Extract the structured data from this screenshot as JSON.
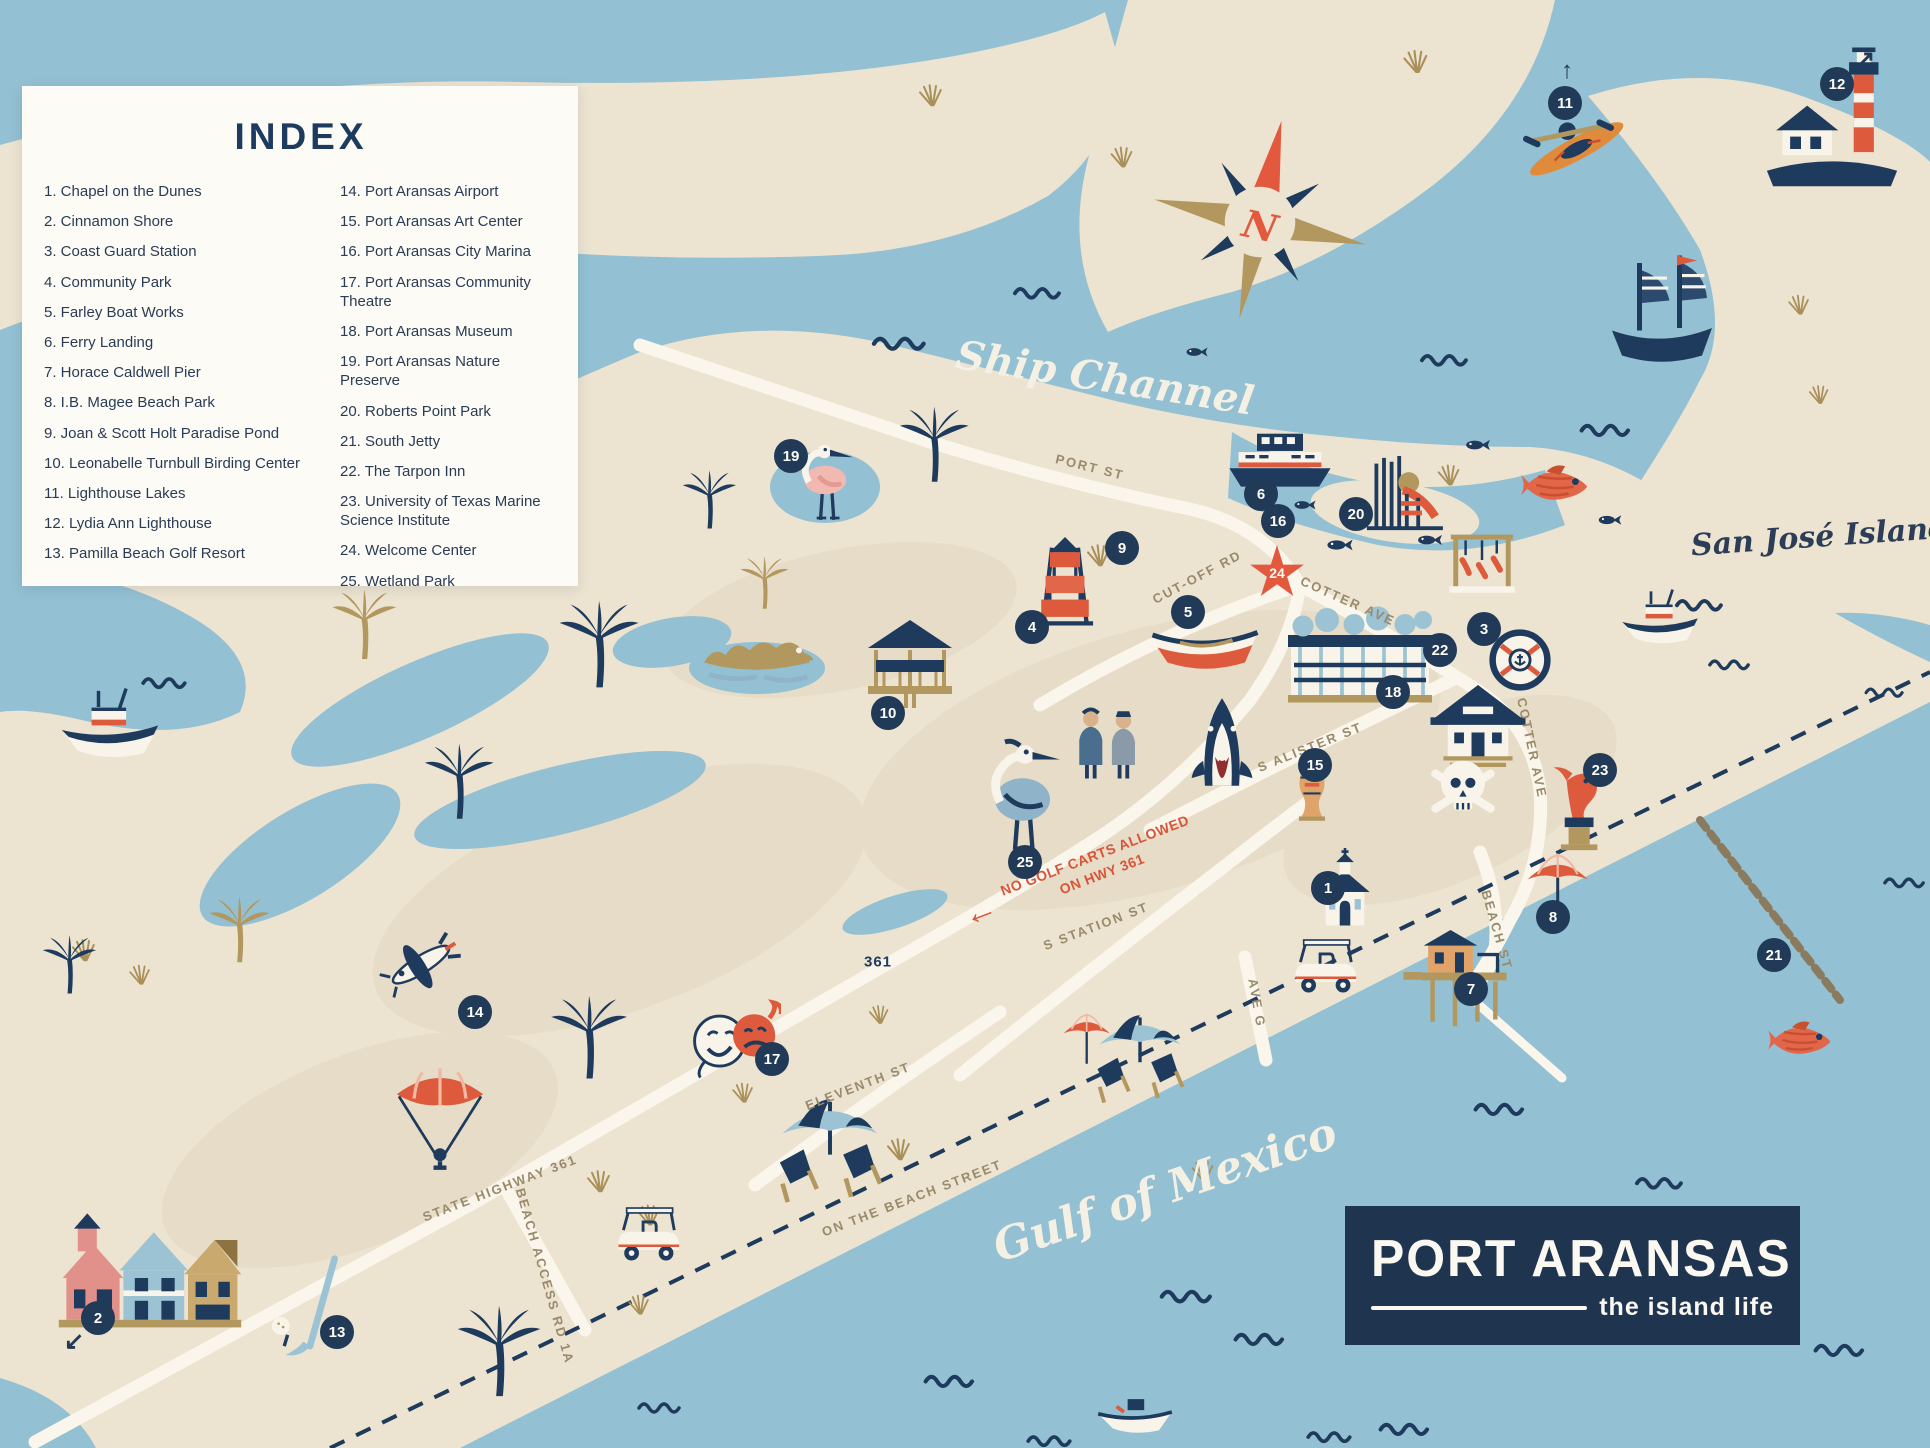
{
  "palette": {
    "water": "#93c0d2",
    "sand": "#ece3d0",
    "sand_dark": "#e3d7c0",
    "navy": "#1e3a5c",
    "orange": "#dd5a3c",
    "tan": "#b2985f",
    "road": "#faf6ec",
    "logo_bg": "#1e344f",
    "index_bg": "#fcfbf6"
  },
  "index": {
    "title": "INDEX",
    "column1": [
      {
        "n": "1.",
        "label": "Chapel on the Dunes"
      },
      {
        "n": "2.",
        "label": "Cinnamon Shore"
      },
      {
        "n": "3.",
        "label": "Coast Guard Station"
      },
      {
        "n": "4.",
        "label": "Community Park"
      },
      {
        "n": "5.",
        "label": "Farley Boat Works"
      },
      {
        "n": "6.",
        "label": "Ferry Landing"
      },
      {
        "n": "7.",
        "label": "Horace Caldwell Pier"
      },
      {
        "n": "8.",
        "label": "I.B. Magee Beach Park"
      },
      {
        "n": "9.",
        "label": "Joan & Scott Holt Paradise Pond"
      },
      {
        "n": "10.",
        "label": "Leonabelle Turnbull Birding Center"
      },
      {
        "n": "11.",
        "label": "Lighthouse Lakes"
      },
      {
        "n": "12.",
        "label": "Lydia Ann Lighthouse"
      },
      {
        "n": "13.",
        "label": "Pamilla Beach Golf Resort"
      }
    ],
    "column2": [
      {
        "n": "14.",
        "label": "Port Aransas Airport"
      },
      {
        "n": "15.",
        "label": "Port Aransas Art Center"
      },
      {
        "n": "16.",
        "label": "Port Aransas City Marina"
      },
      {
        "n": "17.",
        "label": "Port Aransas Community Theatre"
      },
      {
        "n": "18.",
        "label": "Port Aransas Museum"
      },
      {
        "n": "19.",
        "label": "Port Aransas Nature Preserve"
      },
      {
        "n": "20.",
        "label": "Roberts Point Park"
      },
      {
        "n": "21.",
        "label": "South Jetty"
      },
      {
        "n": "22.",
        "label": "The Tarpon Inn"
      },
      {
        "n": "23.",
        "label": "University of Texas Marine Science Institute"
      },
      {
        "n": "24.",
        "label": "Welcome Center"
      },
      {
        "n": "25.",
        "label": "Wetland Park"
      }
    ]
  },
  "logo": {
    "title": "PORT ARANSAS",
    "tagline": "the island life"
  },
  "compass": {
    "label": "N"
  },
  "warning": {
    "arrow_icon": "←",
    "line1": "NO GOLF CARTS ALLOWED",
    "line2": "ON HWY 361"
  },
  "water_labels": [
    {
      "text": "Ship Channel",
      "x": 1105,
      "y": 378,
      "r": 9,
      "cls": "script-white",
      "size": 40
    },
    {
      "text": "Gulf of Mexico",
      "x": 1165,
      "y": 1190,
      "r": -19,
      "cls": "script-white",
      "size": 44
    },
    {
      "text": "San José Island",
      "x": 1820,
      "y": 537,
      "r": -4,
      "cls": "script-navy",
      "size": 30
    }
  ],
  "street_labels": [
    {
      "text": "PORT ST",
      "x": 1090,
      "y": 467,
      "r": 14
    },
    {
      "text": "CUT-OFF RD",
      "x": 1197,
      "y": 577,
      "r": -28
    },
    {
      "text": "COTTER AVE",
      "x": 1348,
      "y": 601,
      "r": 24
    },
    {
      "text": "COTTER AVE",
      "x": 1532,
      "y": 748,
      "r": 78
    },
    {
      "text": "S ALISTER ST",
      "x": 1310,
      "y": 747,
      "r": -22
    },
    {
      "text": "S STATION ST",
      "x": 1096,
      "y": 926,
      "r": -21
    },
    {
      "text": "AVE G",
      "x": 1257,
      "y": 1003,
      "r": 80
    },
    {
      "text": "BEACH ST",
      "x": 1497,
      "y": 930,
      "r": 74
    },
    {
      "text": "ELEVENTH ST",
      "x": 858,
      "y": 1086,
      "r": -21
    },
    {
      "text": "ON THE BEACH STREET",
      "x": 912,
      "y": 1198,
      "r": -21
    },
    {
      "text": "STATE HIGHWAY 361",
      "x": 500,
      "y": 1188,
      "r": -21
    },
    {
      "text": "BEACH ACCESS RD 1A",
      "x": 545,
      "y": 1276,
      "r": 74
    },
    {
      "text": "361",
      "x": 878,
      "y": 962,
      "r": 0,
      "badge": true
    }
  ],
  "markers": [
    {
      "n": "1",
      "x": 1328,
      "y": 888
    },
    {
      "n": "2",
      "x": 98,
      "y": 1318,
      "arrow": "↙",
      "ax": -24,
      "ay": 24
    },
    {
      "n": "3",
      "x": 1484,
      "y": 629
    },
    {
      "n": "4",
      "x": 1032,
      "y": 627
    },
    {
      "n": "5",
      "x": 1188,
      "y": 612
    },
    {
      "n": "6",
      "x": 1261,
      "y": 494
    },
    {
      "n": "7",
      "x": 1471,
      "y": 989
    },
    {
      "n": "8",
      "x": 1553,
      "y": 917
    },
    {
      "n": "9",
      "x": 1122,
      "y": 548
    },
    {
      "n": "10",
      "x": 888,
      "y": 713
    },
    {
      "n": "11",
      "x": 1565,
      "y": 103,
      "arrow": "↑",
      "ax": 2,
      "ay": -32
    },
    {
      "n": "12",
      "x": 1837,
      "y": 84,
      "arrow": "↗",
      "ax": 28,
      "ay": -24
    },
    {
      "n": "13",
      "x": 337,
      "y": 1332
    },
    {
      "n": "14",
      "x": 475,
      "y": 1012
    },
    {
      "n": "15",
      "x": 1315,
      "y": 765
    },
    {
      "n": "16",
      "x": 1278,
      "y": 521
    },
    {
      "n": "17",
      "x": 772,
      "y": 1059
    },
    {
      "n": "18",
      "x": 1393,
      "y": 692
    },
    {
      "n": "19",
      "x": 791,
      "y": 456
    },
    {
      "n": "20",
      "x": 1356,
      "y": 514
    },
    {
      "n": "21",
      "x": 1774,
      "y": 955
    },
    {
      "n": "22",
      "x": 1440,
      "y": 650
    },
    {
      "n": "23",
      "x": 1600,
      "y": 770
    },
    {
      "n": "24",
      "x": 1277,
      "y": 573,
      "star": true
    },
    {
      "n": "25",
      "x": 1025,
      "y": 862
    }
  ],
  "decorations": [
    {
      "t": "wave",
      "x": 320,
      "y": 386,
      "s": 60
    },
    {
      "t": "wave",
      "x": 520,
      "y": 366,
      "s": 55
    },
    {
      "t": "wave",
      "x": 900,
      "y": 340,
      "s": 62
    },
    {
      "t": "wave",
      "x": 1038,
      "y": 290,
      "s": 55
    },
    {
      "t": "wave",
      "x": 1445,
      "y": 357,
      "s": 55
    },
    {
      "t": "wave",
      "x": 1606,
      "y": 427,
      "s": 58
    },
    {
      "t": "wave",
      "x": 1700,
      "y": 602,
      "s": 55
    },
    {
      "t": "wave",
      "x": 1730,
      "y": 662,
      "s": 48
    },
    {
      "t": "wave",
      "x": 165,
      "y": 680,
      "s": 52
    },
    {
      "t": "wave",
      "x": 1187,
      "y": 1293,
      "s": 60
    },
    {
      "t": "wave",
      "x": 1260,
      "y": 1336,
      "s": 58
    },
    {
      "t": "wave",
      "x": 1405,
      "y": 1426,
      "s": 58
    },
    {
      "t": "wave",
      "x": 1500,
      "y": 1106,
      "s": 58
    },
    {
      "t": "wave",
      "x": 1660,
      "y": 1180,
      "s": 55
    },
    {
      "t": "wave",
      "x": 1750,
      "y": 1258,
      "s": 55
    },
    {
      "t": "wave",
      "x": 1840,
      "y": 1347,
      "s": 58
    },
    {
      "t": "wave",
      "x": 950,
      "y": 1378,
      "s": 58
    },
    {
      "t": "wave",
      "x": 1050,
      "y": 1438,
      "s": 52
    },
    {
      "t": "wave",
      "x": 1330,
      "y": 1434,
      "s": 52
    },
    {
      "t": "wave",
      "x": 660,
      "y": 1405,
      "s": 50
    },
    {
      "t": "wave",
      "x": 1885,
      "y": 690,
      "s": 45
    },
    {
      "t": "wave",
      "x": 1905,
      "y": 880,
      "s": 48
    },
    {
      "t": "grass",
      "x": 932,
      "y": 90,
      "s": 40,
      "c": "#a98f58"
    },
    {
      "t": "grass",
      "x": 1123,
      "y": 152,
      "s": 38,
      "c": "#a98f58"
    },
    {
      "t": "grass",
      "x": 1417,
      "y": 56,
      "s": 42,
      "c": "#a98f58"
    },
    {
      "t": "grass",
      "x": 1800,
      "y": 300,
      "s": 36,
      "c": "#a98f58"
    },
    {
      "t": "grass",
      "x": 1820,
      "y": 390,
      "s": 34,
      "c": "#a98f58"
    },
    {
      "t": "grass",
      "x": 1450,
      "y": 470,
      "s": 38,
      "c": "#a98f58"
    },
    {
      "t": "grass",
      "x": 85,
      "y": 945,
      "s": 40,
      "c": "#a98f58"
    },
    {
      "t": "grass",
      "x": 141,
      "y": 970,
      "s": 36,
      "c": "#a98f58"
    },
    {
      "t": "grass",
      "x": 600,
      "y": 1176,
      "s": 40,
      "c": "#a98f58"
    },
    {
      "t": "grass",
      "x": 650,
      "y": 1210,
      "s": 38,
      "c": "#a98f58"
    },
    {
      "t": "grass",
      "x": 900,
      "y": 1144,
      "s": 40,
      "c": "#a98f58"
    },
    {
      "t": "grass",
      "x": 1204,
      "y": 1166,
      "s": 38,
      "c": "#a98f58"
    },
    {
      "t": "grass",
      "x": 640,
      "y": 1300,
      "s": 36,
      "c": "#a98f58"
    },
    {
      "t": "grass",
      "x": 880,
      "y": 1010,
      "s": 34,
      "c": "#a98f58"
    },
    {
      "t": "grass",
      "x": 1100,
      "y": 550,
      "s": 40,
      "c": "#a98f58"
    },
    {
      "t": "grass",
      "x": 744,
      "y": 1088,
      "s": 36,
      "c": "#a98f58"
    },
    {
      "t": "fish",
      "x": 1340,
      "y": 545,
      "s": 36
    },
    {
      "t": "fish",
      "x": 1430,
      "y": 540,
      "s": 34
    },
    {
      "t": "fish",
      "x": 1478,
      "y": 445,
      "s": 34
    },
    {
      "t": "fish",
      "x": 1197,
      "y": 352,
      "s": 30
    },
    {
      "t": "fish",
      "x": 1305,
      "y": 505,
      "s": 30
    },
    {
      "t": "fish",
      "x": 1610,
      "y": 520,
      "s": 32
    },
    {
      "t": "snapper",
      "x": 1555,
      "y": 485,
      "s": 85
    },
    {
      "t": "snapper",
      "x": 1800,
      "y": 1040,
      "s": 80
    },
    {
      "t": "palm",
      "x": 935,
      "y": 445,
      "s": 80
    },
    {
      "t": "palm",
      "x": 710,
      "y": 500,
      "s": 62
    },
    {
      "t": "palm",
      "x": 600,
      "y": 645,
      "s": 92
    },
    {
      "t": "palm",
      "x": 460,
      "y": 782,
      "s": 80
    },
    {
      "t": "palm",
      "x": 590,
      "y": 1038,
      "s": 88
    },
    {
      "t": "palm",
      "x": 500,
      "y": 1352,
      "s": 96
    },
    {
      "t": "palm",
      "x": 70,
      "y": 965,
      "s": 62
    },
    {
      "t": "palm",
      "x": 365,
      "y": 625,
      "s": 74,
      "c": "#b2985f"
    },
    {
      "t": "palm",
      "x": 765,
      "y": 583,
      "s": 56,
      "c": "#b2985f"
    },
    {
      "t": "palm",
      "x": 240,
      "y": 930,
      "s": 70,
      "c": "#b2985f"
    },
    {
      "t": "compassrose",
      "x": 1260,
      "y": 222,
      "s": 235
    },
    {
      "t": "ferry",
      "x": 1280,
      "y": 459,
      "s": 115
    },
    {
      "t": "pirate",
      "x": 1662,
      "y": 308,
      "s": 125
    },
    {
      "t": "lighthouse",
      "x": 1832,
      "y": 118,
      "s": 155
    },
    {
      "t": "kayak",
      "x": 1572,
      "y": 140,
      "s": 125,
      "r": -28
    },
    {
      "t": "rowboat",
      "x": 1205,
      "y": 645,
      "s": 125
    },
    {
      "t": "motorboat",
      "x": 110,
      "y": 730,
      "s": 115
    },
    {
      "t": "motorboat",
      "x": 1660,
      "y": 622,
      "s": 90
    },
    {
      "t": "smallboat",
      "x": 1135,
      "y": 1412,
      "s": 92
    },
    {
      "t": "spoonbill",
      "x": 830,
      "y": 480,
      "s": 95
    },
    {
      "t": "heron",
      "x": 1025,
      "y": 792,
      "s": 125
    },
    {
      "t": "shark",
      "x": 1222,
      "y": 742,
      "s": 95
    },
    {
      "t": "gator",
      "x": 757,
      "y": 660,
      "s": 120,
      "c": "#b2985f"
    },
    {
      "t": "gazebo",
      "x": 910,
      "y": 664,
      "s": 100
    },
    {
      "t": "playground",
      "x": 1403,
      "y": 494,
      "s": 95
    },
    {
      "t": "weigh",
      "x": 1482,
      "y": 560,
      "s": 82
    },
    {
      "t": "tower",
      "x": 1065,
      "y": 578,
      "s": 108
    },
    {
      "t": "inn",
      "x": 1360,
      "y": 650,
      "s": 150
    },
    {
      "t": "museum",
      "x": 1478,
      "y": 726,
      "s": 108
    },
    {
      "t": "chapel",
      "x": 1345,
      "y": 892,
      "s": 88
    },
    {
      "t": "houses",
      "x": 150,
      "y": 1278,
      "s": 190
    },
    {
      "t": "pierhouse",
      "x": 1455,
      "y": 977,
      "s": 112
    },
    {
      "t": "golfcart",
      "x": 1325,
      "y": 972,
      "s": 82
    },
    {
      "t": "golfcart",
      "x": 648,
      "y": 1240,
      "s": 82
    },
    {
      "t": "plane",
      "x": 420,
      "y": 963,
      "s": 96
    },
    {
      "t": "parasail",
      "x": 440,
      "y": 1118,
      "s": 108
    },
    {
      "t": "masks",
      "x": 733,
      "y": 1043,
      "s": 96
    },
    {
      "t": "orangeumb",
      "x": 1090,
      "y": 1040,
      "s": 66
    },
    {
      "t": "umbrella2",
      "x": 1140,
      "y": 1060,
      "s": 112
    },
    {
      "t": "umbrella2",
      "x": 830,
      "y": 1152,
      "s": 132
    },
    {
      "t": "orangeumb",
      "x": 1562,
      "y": 888,
      "s": 86
    },
    {
      "t": "statue",
      "x": 1582,
      "y": 806,
      "s": 96
    },
    {
      "t": "skull",
      "x": 1463,
      "y": 792,
      "s": 92
    },
    {
      "t": "vase",
      "x": 1312,
      "y": 792,
      "s": 72
    },
    {
      "t": "cgseal",
      "x": 1520,
      "y": 660,
      "s": 72
    },
    {
      "t": "golfset",
      "x": 310,
      "y": 1308,
      "s": 112
    },
    {
      "t": "people",
      "x": 1110,
      "y": 742,
      "s": 96
    }
  ]
}
